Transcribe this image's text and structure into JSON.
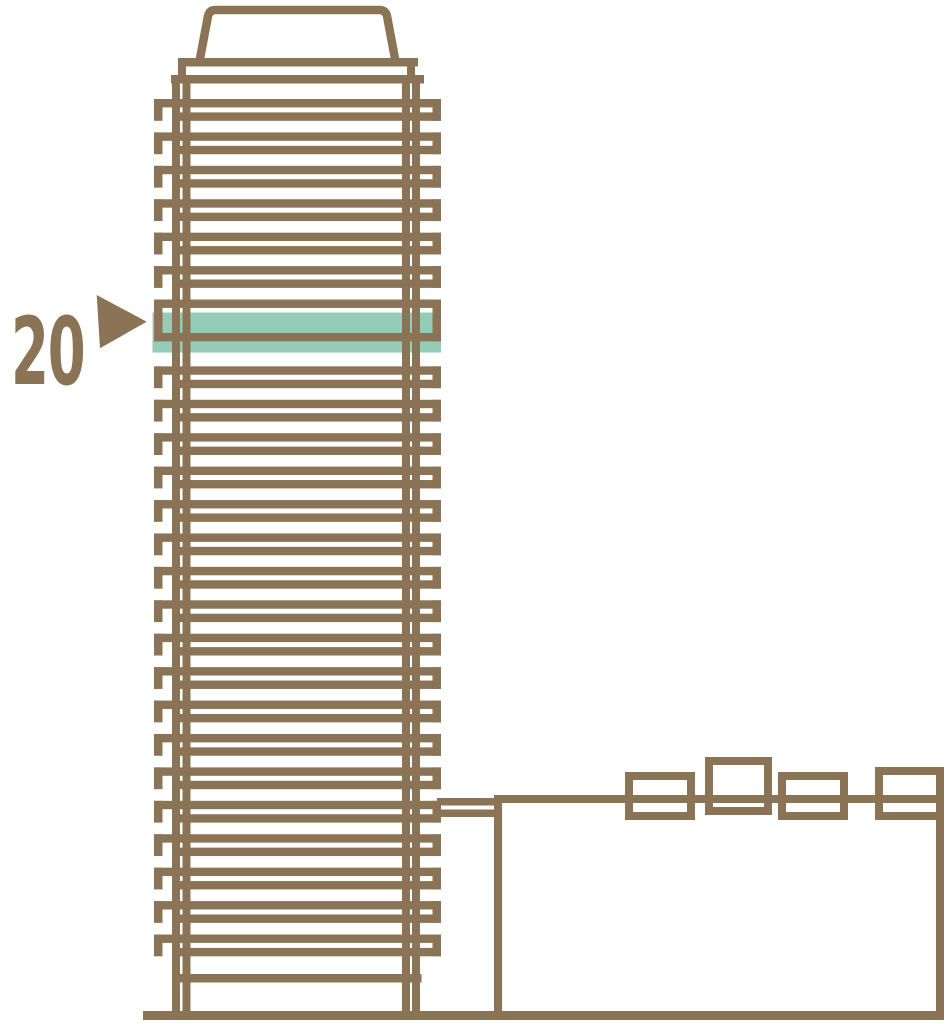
{
  "diagram": {
    "floor_label": "20",
    "building": {
      "total_floor_lines": 26,
      "highlighted_floor_label": "20",
      "highlighted_index_from_top": 6
    },
    "colors": {
      "outline": "#8b7355",
      "highlight": "#94ccb8",
      "background": "#ffffff"
    }
  }
}
